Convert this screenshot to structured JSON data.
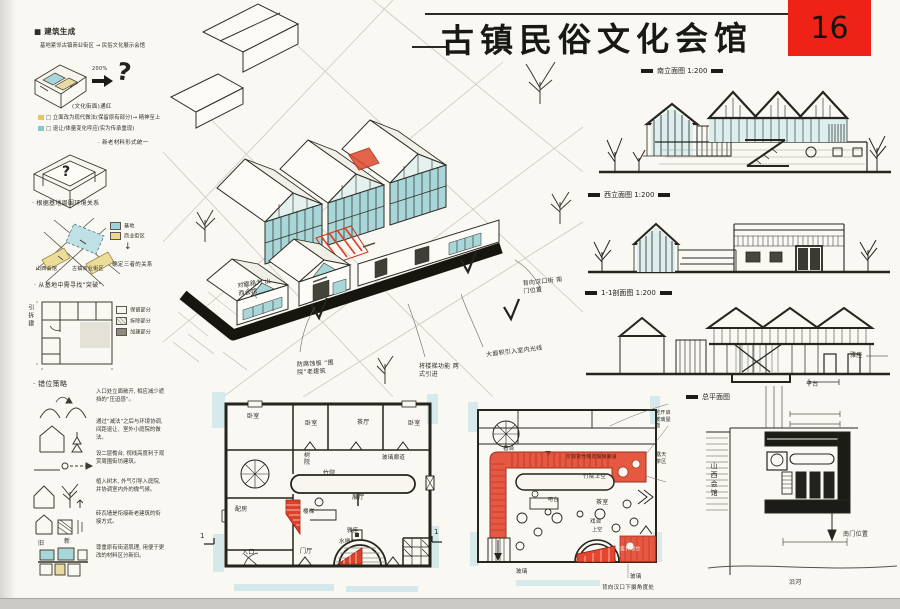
{
  "header": {
    "title": "古镇民俗文化会馆",
    "page_number": "16"
  },
  "sidebar": {
    "s1_heading": "■ 建筑生成",
    "s1_line": "基地紧邻古镇商业街区 → 民俗文化展示会馆",
    "s1_zoom": "200%",
    "s1_question": "?",
    "s1_arrow_note": "(文化街面)通红",
    "s1_note1": "□ 立面改为现代做法(保留原有部分)→ 精神至上",
    "s1_note2": "□ 退让/体量变化呼应(实为传承重现)",
    "s1_note3": "· 新老材料形式统一",
    "s2_question": "?",
    "s2_heading": "· 根据基地周围环境关系",
    "s2_legend_site": "基地",
    "s2_legend_street": "商业街区",
    "s2_label_left": "山西会馆",
    "s2_label_right": "古镇商业街区",
    "s2_arrow": "↓",
    "s2_note1": "· 确定三者的关系",
    "s2_note2": "· 从基地中需寻找“突破”",
    "s3_side_label": "引拆建",
    "s3_legend": [
      "保留部分",
      "拆除部分",
      "加建部分"
    ],
    "s4_heading": "· 错位策略",
    "s4_rows": [
      {
        "text": "入口处立面敞开, 相应减少遮挡的“压迫感”。"
      },
      {
        "text": "通过“减法”之后与环境协调, 间距退让、室外小庭院的做法。"
      },
      {
        "text": "设二层檐台, 视线高度利于观赏周围街坊建筑。"
      },
      {
        "text": "植入树木, 外气引导入庭院, 并协调室内外的微气候。"
      },
      {
        "text": "砖瓦墙是衔接新老建筑的衔接方式。"
      },
      {
        "text": "尊重原有街道肌理, 用便于更改的材料区分新旧。"
      }
    ],
    "s4_tag_old": "旧",
    "s4_tag_new": "新"
  },
  "axon": {
    "ann_opposite": "对面路为 山西会馆",
    "ann_wood": "防腐蚀板 “围院”老建筑",
    "ann_stair": "将楼梯功能 两式引进",
    "ann_light": "大面积引入室内光线",
    "ann_south": "背向汉口街 南门位置"
  },
  "elevations": {
    "south_label": "南立面图 1:200",
    "west_label": "西立面图 1:200",
    "section_label": "1-1剖面图 1:200",
    "site_label": "总平面图",
    "section_ann_seat": "雅座",
    "section_ann_platform": "平台",
    "site_ann_guild": "山西会馆",
    "site_ann_gate": "南门位置",
    "site_ann_river": "沿河"
  },
  "plan1": {
    "rooms": {
      "bedroom1": "卧室",
      "bedroom2": "卧室",
      "tea_hall": "茶厅",
      "bedroom3": "卧室",
      "tree_court": "树院",
      "glass_corridor": "玻璃廊道",
      "bamboo_court": "竹院",
      "exhibit_hall": "展厅",
      "side_room": "配房",
      "stair": "楼梯",
      "entry_hall": "门厅",
      "entrance": "入口",
      "water_bar": "水吧",
      "seat": "雅座"
    },
    "section_marker": "1"
  },
  "plan2": {
    "labels": {
      "viewing": "看台",
      "down": "下",
      "corridor_note": "可观赏竹院及玻璃廊道",
      "bamboo_void": "竹院上空",
      "bar": "吧台",
      "tea_room": "茶室",
      "stage": "戏台",
      "void": "上空",
      "terrace": "室外观台",
      "open_roof": "可开启玻璃屋面",
      "outdoor_tea": "露天茶区",
      "glass": "玻璃",
      "note": "背向汉口下摄角度处"
    }
  }
}
